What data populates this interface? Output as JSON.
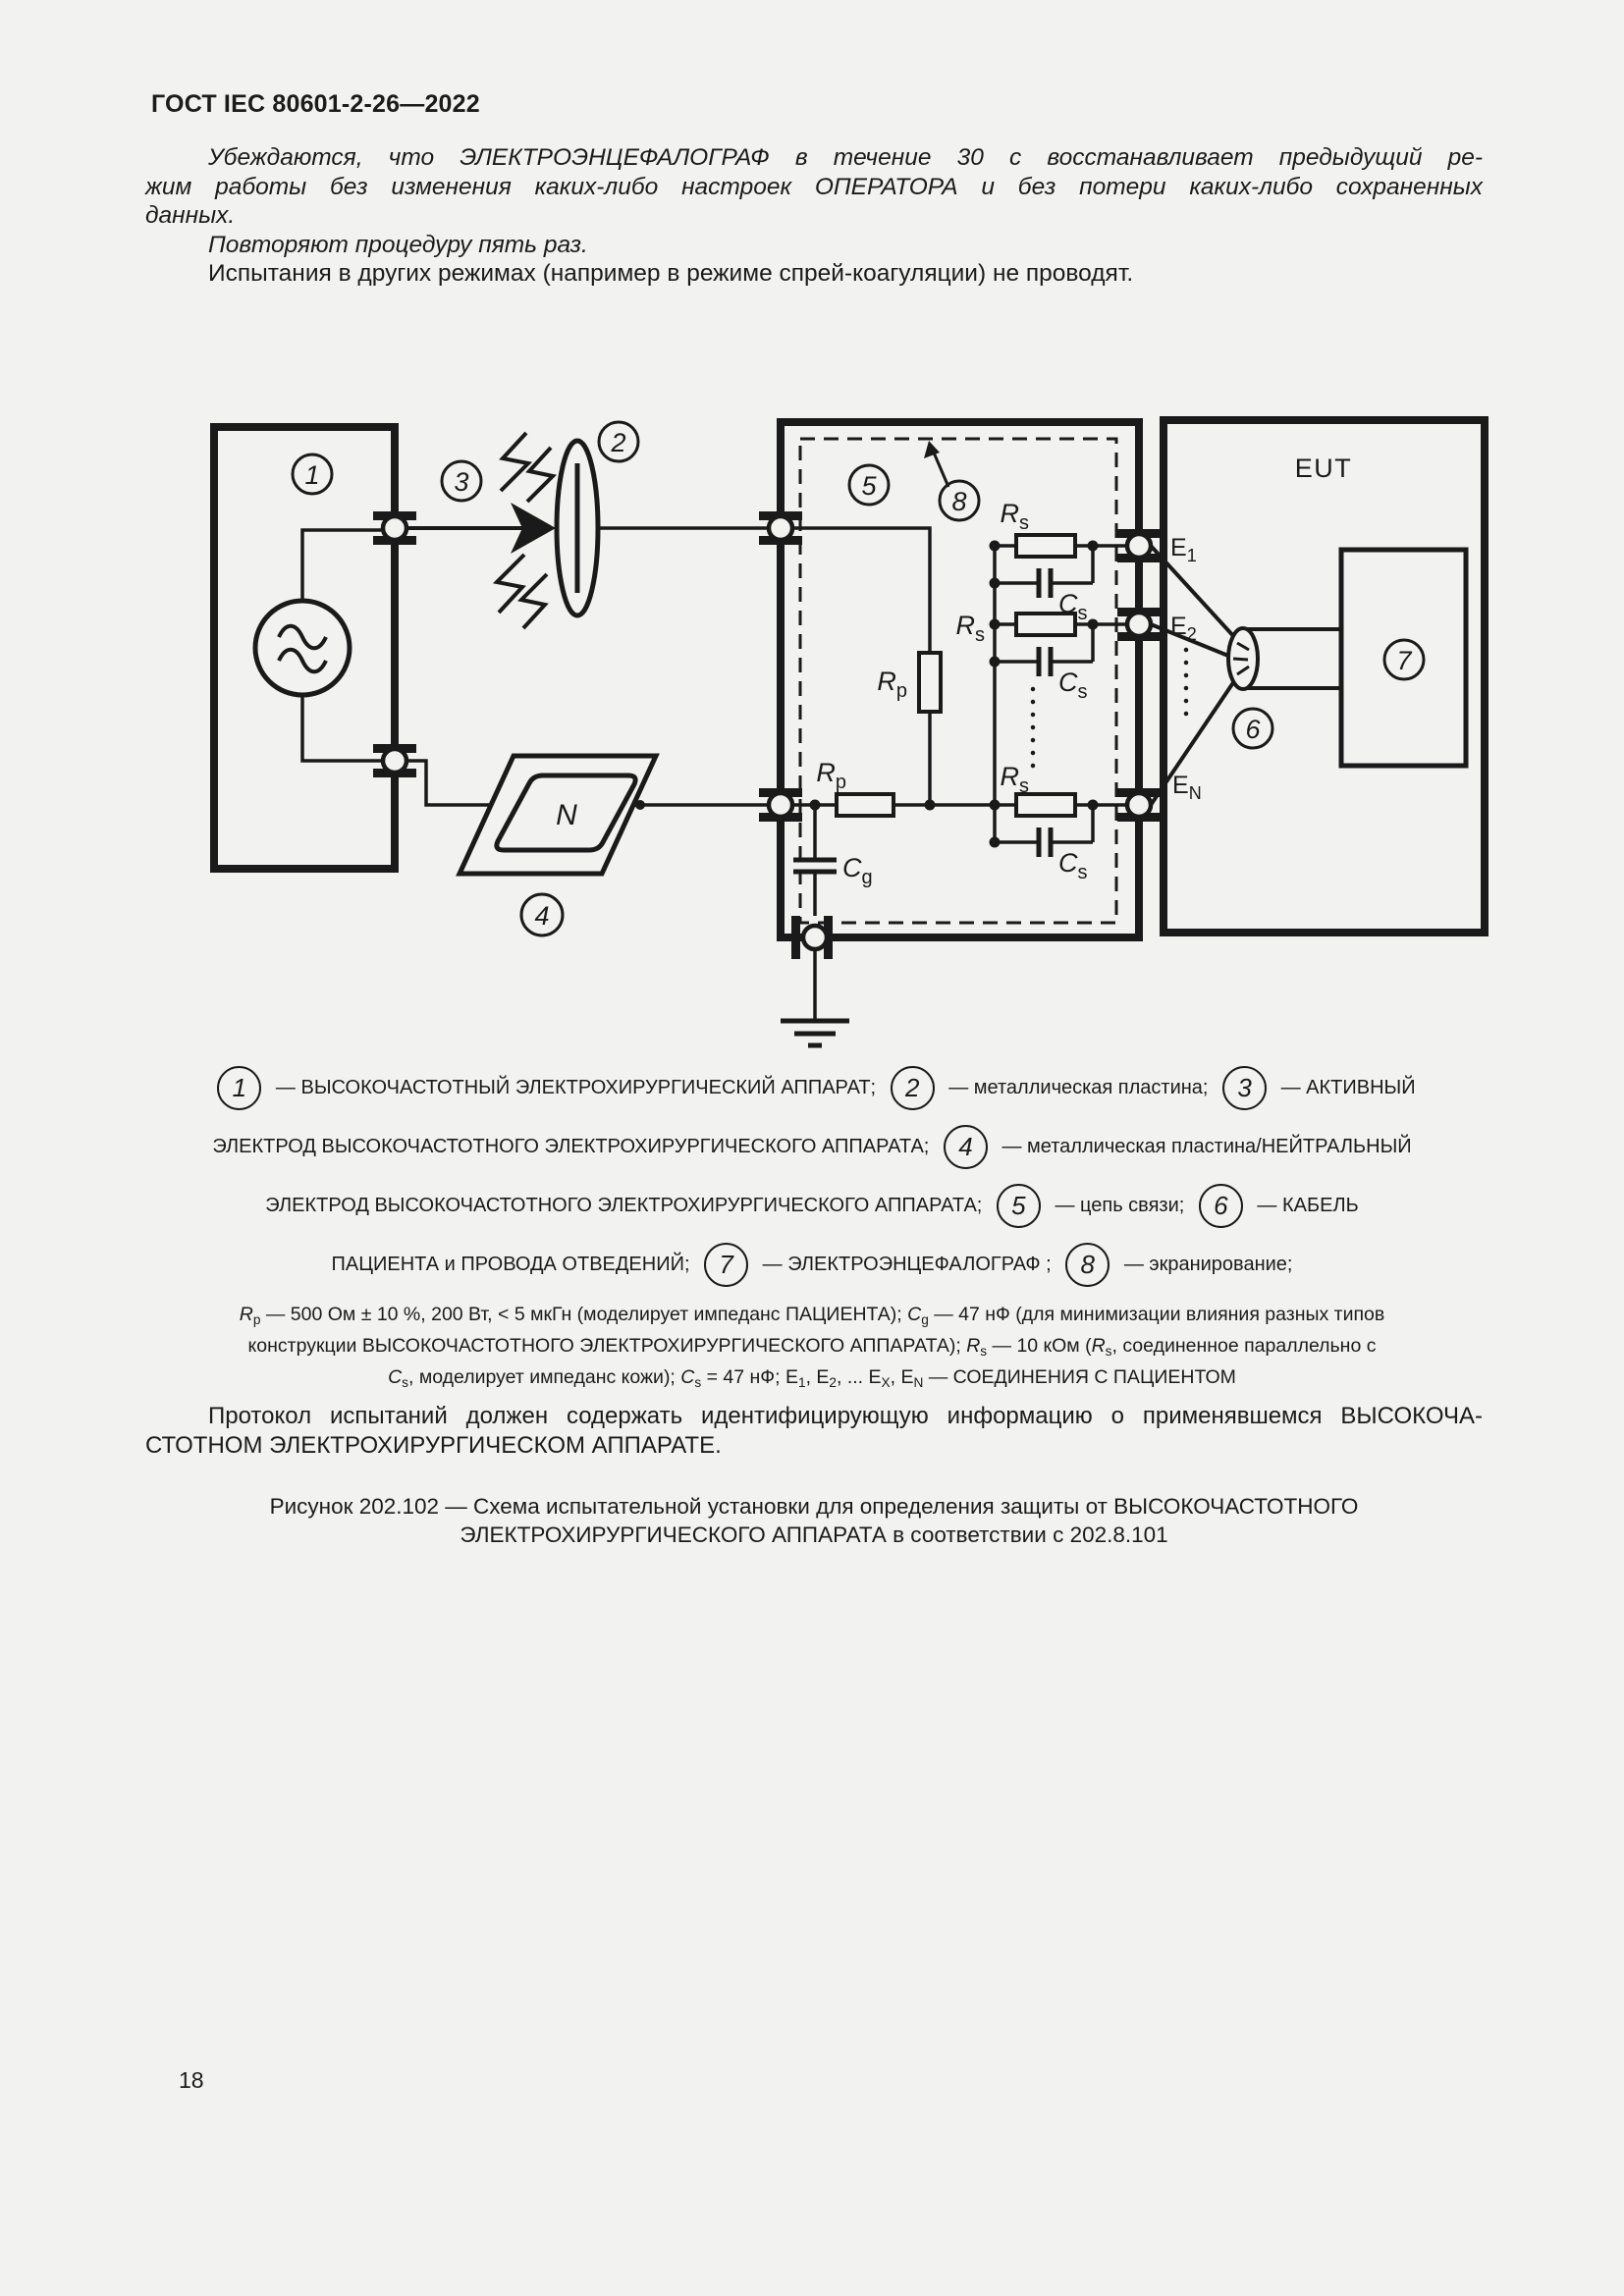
{
  "colors": {
    "background": "#f2f2f0",
    "ink": "#1a1a1a"
  },
  "header": {
    "title": "ГОСТ IEC 80601-2-26—2022"
  },
  "page": {
    "number": "18"
  },
  "intro": {
    "p1_lines": [
      "Убеждаются, что ЭЛЕКТРОЭНЦЕФАЛОГРАФ в течение 30 с восстанавливает предыдущий ре-",
      "жим работы без изменения каких-либо настроек ОПЕРАТОРА и без потери каких-либо сохраненных",
      "данных."
    ],
    "p2": "Повторяют процедуру пять раз.",
    "p3": "Испытания в других режимах (например в режиме спрей-коагуляции) не проводят."
  },
  "diagram": {
    "callouts": {
      "c1": "1",
      "c2": "2",
      "c3": "3",
      "c4": "4",
      "c5": "5",
      "c6": "6",
      "c7": "7",
      "c8": "8"
    },
    "labels": {
      "eut": "EUT",
      "n_plate": "N",
      "rp": {
        "main": "R",
        "sub": "p"
      },
      "rs": {
        "main": "R",
        "sub": "s"
      },
      "cs": {
        "main": "C",
        "sub": "s"
      },
      "cg": {
        "main": "C",
        "sub": "g"
      },
      "e1": {
        "main": "E",
        "sub": "1"
      },
      "e2": {
        "main": "E",
        "sub": "2"
      },
      "en": {
        "main": "E",
        "sub": "N"
      }
    }
  },
  "legend": {
    "rows": [
      [
        {
          "c": "1"
        },
        {
          "t": " — ВЫСОКОЧАСТОТНЫЙ ЭЛЕКТРОХИРУРГИЧЕСКИЙ АППАРАТ; "
        },
        {
          "c": "2"
        },
        {
          "t": " — металлическая пластина; "
        },
        {
          "c": "3"
        },
        {
          "t": " — АКТИВНЫЙ"
        }
      ],
      [
        {
          "t": "ЭЛЕКТРОД ВЫСОКОЧАСТОТНОГО ЭЛЕКТРОХИРУРГИЧЕСКОГО АППАРАТА; "
        },
        {
          "c": "4"
        },
        {
          "t": " — металлическая пластина/НЕЙТРАЛЬНЫЙ"
        }
      ],
      [
        {
          "t": "ЭЛЕКТРОД ВЫСОКОЧАСТОТНОГО ЭЛЕКТРОХИРУРГИЧЕСКОГО АППАРАТА; "
        },
        {
          "c": "5"
        },
        {
          "t": " — цепь связи; "
        },
        {
          "c": "6"
        },
        {
          "t": " — КАБЕЛЬ"
        }
      ],
      [
        {
          "t": "ПАЦИЕНТА и ПРОВОДА ОТВЕДЕНИЙ; "
        },
        {
          "c": "7"
        },
        {
          "t": " — ЭЛЕКТРОЭНЦЕФАЛОГРАФ ; "
        },
        {
          "c": "8"
        },
        {
          "t": " — экранирование;"
        }
      ]
    ]
  },
  "params": {
    "lines": [
      [
        {
          "s": "i",
          "t": "R"
        },
        {
          "s": "sub",
          "t": "p"
        },
        {
          "t": " — 500 Ом ± 10 %, 200 Вт, < 5 мкГн (моделирует импеданс ПАЦИЕНТА); "
        },
        {
          "s": "i",
          "t": "C"
        },
        {
          "s": "sub",
          "t": "g"
        },
        {
          "t": " — 47 нФ (для минимизации влияния разных типов"
        }
      ],
      [
        {
          "t": "конструкции ВЫСОКОЧАСТОТНОГО ЭЛЕКТРОХИРУРГИЧЕСКОГО АППАРАТА); "
        },
        {
          "s": "i",
          "t": "R"
        },
        {
          "s": "sub",
          "t": "s"
        },
        {
          "t": " — 10 кОм ("
        },
        {
          "s": "i",
          "t": "R"
        },
        {
          "s": "sub",
          "t": "s"
        },
        {
          "t": ", соединенное параллельно с"
        }
      ],
      [
        {
          "s": "i",
          "t": "C"
        },
        {
          "s": "sub",
          "t": "s"
        },
        {
          "t": ", моделирует импеданс кожи); "
        },
        {
          "s": "i",
          "t": "C"
        },
        {
          "s": "sub",
          "t": "s"
        },
        {
          "t": " = 47 нФ; E"
        },
        {
          "s": "sub",
          "t": "1"
        },
        {
          "t": ", E"
        },
        {
          "s": "sub",
          "t": "2"
        },
        {
          "t": ", ... E"
        },
        {
          "s": "sub",
          "t": "X"
        },
        {
          "t": ", E"
        },
        {
          "s": "sub",
          "t": "N"
        },
        {
          "t": " — СОЕДИНЕНИЯ С ПАЦИЕНТОМ"
        }
      ]
    ]
  },
  "protocol": {
    "lines": [
      "Протокол испытаний должен содержать идентифицирующую информацию о применявшемся ВЫСОКОЧА-",
      "СТОТНОМ ЭЛЕКТРОХИРУРГИЧЕСКОМ АППАРАТЕ."
    ]
  },
  "caption": {
    "lines": [
      "Рисунок 202.102 — Схема испытательной установки для определения защиты от ВЫСОКОЧАСТОТНОГО",
      "ЭЛЕКТРОХИРУРГИЧЕСКОГО АППАРАТА в соответствии с 202.8.101"
    ]
  }
}
